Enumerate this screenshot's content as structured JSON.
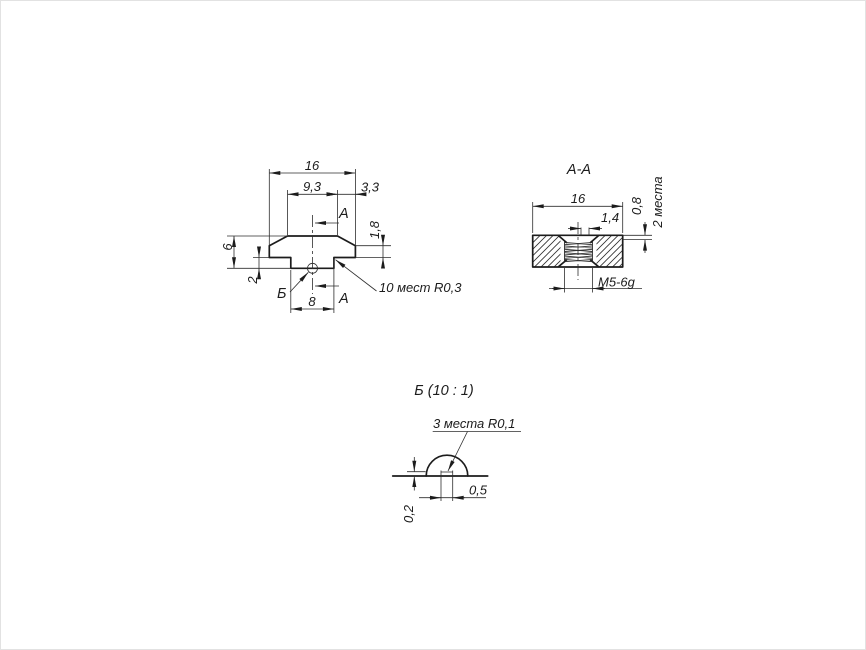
{
  "drawing": {
    "front_view": {
      "dim_total_width": "16",
      "dim_top_width": "9,3",
      "dim_side_width": "3,3",
      "dim_total_height": "6",
      "dim_step_height": "2",
      "dim_bottom_width": "8",
      "dim_chamfer_height": "1,8",
      "note_fillets": "10 мест R0,3",
      "section_letter": "А",
      "detail_letter": "Б"
    },
    "section_view": {
      "title": "А-А",
      "dim_width": "16",
      "dim_offset": "1,4",
      "dim_land": "0,8",
      "note_places": "2 места",
      "thread_label": "М5-6g"
    },
    "detail_view": {
      "title": "Б (10 : 1)",
      "note_radii": "3 места R0,1",
      "dim_depth": "0,2",
      "dim_width": "0,5"
    },
    "colors": {
      "outline": "#1c1c1c",
      "thin_line": "#2e2e2e",
      "background": "#ffffff",
      "frame": "#e2e2e2"
    }
  }
}
